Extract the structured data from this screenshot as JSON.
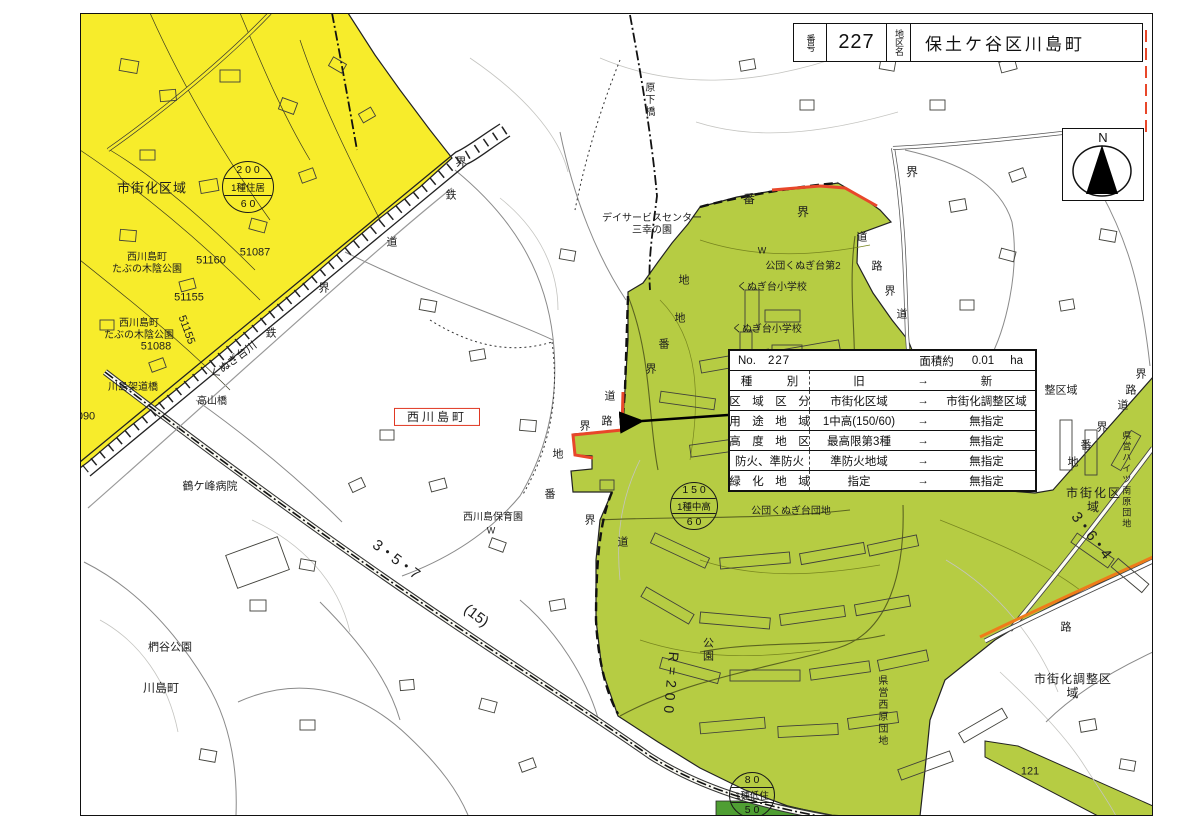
{
  "header": {
    "no_label": "番号",
    "no_value": "227",
    "name_label": "地区名",
    "name_value": "保土ケ谷区川島町"
  },
  "compass": {
    "north_label": "N"
  },
  "info_table": {
    "no_label": "No.",
    "no_value": "227",
    "area_label": "面積約",
    "area_value": "0.01",
    "area_unit": "ha",
    "arrow": "→",
    "rows": [
      {
        "label": "種　　　別",
        "old": "旧",
        "new": "新"
      },
      {
        "label": "区　域　区　分",
        "old": "市街化区域",
        "new": "市街化調整区域"
      },
      {
        "label": "用　途　地　域",
        "old": "1中高(150/60)",
        "new": "無指定"
      },
      {
        "label": "高　度　地　区",
        "old": "最高限第3種",
        "new": "無指定"
      },
      {
        "label": "防火、準防火",
        "old": "準防火地域",
        "new": "無指定"
      },
      {
        "label": "緑　化　地　域",
        "old": "指定",
        "new": "無指定"
      }
    ]
  },
  "colors": {
    "urbanization_yellow": "#f7ec2b",
    "estate_green": "#b6cc43",
    "dark_green": "#4f9e33",
    "boundary_red": "#e8472a",
    "road_orange": "#ef7b1a"
  },
  "zoning_circles": [
    {
      "x": 248,
      "y": 187,
      "r": 26,
      "lines": [
        "2 0 0",
        "1種住居",
        "6 0"
      ]
    },
    {
      "x": 694,
      "y": 506,
      "r": 24,
      "lines": [
        "1 5 0",
        "1種中高",
        "6 0"
      ]
    },
    {
      "x": 752,
      "y": 795,
      "r": 23,
      "lines": [
        "8 0",
        "1種低住",
        "5 0"
      ]
    }
  ],
  "map_labels": [
    {
      "t": "市街化区域",
      "x": 152,
      "y": 188,
      "s": 13,
      "sp": 1
    },
    {
      "t": "西川島町\nたぶの木陰公園",
      "x": 147,
      "y": 264,
      "s": 10
    },
    {
      "t": "51160",
      "x": 211,
      "y": 261,
      "s": 11
    },
    {
      "t": "51087",
      "x": 255,
      "y": 253,
      "s": 11
    },
    {
      "t": "51155",
      "x": 189,
      "y": 298,
      "s": 11
    },
    {
      "t": "51155",
      "x": 186,
      "y": 330,
      "s": 11,
      "r": 70
    },
    {
      "t": "西川島町\nたぶの木陰公園",
      "x": 139,
      "y": 330,
      "s": 10
    },
    {
      "t": "51088",
      "x": 156,
      "y": 347,
      "s": 11
    },
    {
      "t": "090",
      "x": 86,
      "y": 417,
      "s": 11
    },
    {
      "t": "川島架道橋",
      "x": 133,
      "y": 388,
      "s": 10
    },
    {
      "t": "高山橋",
      "x": 212,
      "y": 402,
      "s": 10
    },
    {
      "t": "くぬぎ台川",
      "x": 234,
      "y": 361,
      "s": 11,
      "r": -37
    },
    {
      "t": "界",
      "x": 461,
      "y": 163,
      "s": 11
    },
    {
      "t": "鉄",
      "x": 451,
      "y": 196,
      "s": 11
    },
    {
      "t": "道",
      "x": 392,
      "y": 243,
      "s": 11
    },
    {
      "t": "界",
      "x": 324,
      "y": 289,
      "s": 11
    },
    {
      "t": "鉄",
      "x": 271,
      "y": 334,
      "s": 11
    },
    {
      "t": "鶴ケ峰病院",
      "x": 210,
      "y": 487,
      "s": 11
    },
    {
      "t": "椚谷公園",
      "x": 170,
      "y": 648,
      "s": 11
    },
    {
      "t": "川島町",
      "x": 161,
      "y": 688,
      "s": 12
    },
    {
      "t": "3・5・7",
      "x": 396,
      "y": 560,
      "s": 15,
      "r": 37
    },
    {
      "t": "(15)",
      "x": 476,
      "y": 616,
      "s": 15,
      "r": 37
    },
    {
      "t": "西川島町",
      "x": 437,
      "y": 417,
      "s": 12,
      "box": true
    },
    {
      "t": "西川島保育園",
      "x": 493,
      "y": 518,
      "s": 10
    },
    {
      "t": "W",
      "x": 491,
      "y": 531,
      "s": 9
    },
    {
      "t": "デイサービスセンター\n三幸の園",
      "x": 652,
      "y": 225,
      "s": 10
    },
    {
      "t": "原下橋",
      "x": 648,
      "y": 100,
      "s": 10,
      "v": true
    },
    {
      "t": "地",
      "x": 684,
      "y": 281,
      "s": 11
    },
    {
      "t": "地",
      "x": 680,
      "y": 319,
      "s": 11
    },
    {
      "t": "番",
      "x": 664,
      "y": 345,
      "s": 11
    },
    {
      "t": "界",
      "x": 651,
      "y": 370,
      "s": 11
    },
    {
      "t": "道",
      "x": 610,
      "y": 397,
      "s": 11
    },
    {
      "t": "路",
      "x": 607,
      "y": 422,
      "s": 11
    },
    {
      "t": "界",
      "x": 585,
      "y": 427,
      "s": 11
    },
    {
      "t": "地",
      "x": 558,
      "y": 455,
      "s": 11
    },
    {
      "t": "番",
      "x": 550,
      "y": 495,
      "s": 11
    },
    {
      "t": "界",
      "x": 590,
      "y": 521,
      "s": 11
    },
    {
      "t": "道",
      "x": 623,
      "y": 543,
      "s": 11
    },
    {
      "t": "番",
      "x": 749,
      "y": 199,
      "s": 12
    },
    {
      "t": "界",
      "x": 803,
      "y": 212,
      "s": 12
    },
    {
      "t": "界",
      "x": 912,
      "y": 172,
      "s": 12
    },
    {
      "t": "道",
      "x": 862,
      "y": 238,
      "s": 11
    },
    {
      "t": "路",
      "x": 877,
      "y": 267,
      "s": 11
    },
    {
      "t": "界",
      "x": 890,
      "y": 292,
      "s": 11
    },
    {
      "t": "道",
      "x": 902,
      "y": 315,
      "s": 11
    },
    {
      "t": "W",
      "x": 762,
      "y": 251,
      "s": 9
    },
    {
      "t": "公団くぬぎ台第2",
      "x": 803,
      "y": 267,
      "s": 10
    },
    {
      "t": "くぬぎ台小学校",
      "x": 772,
      "y": 288,
      "s": 10
    },
    {
      "t": "くぬぎ台小学校",
      "x": 767,
      "y": 330,
      "s": 10
    },
    {
      "t": "公団くぬぎ台団地",
      "x": 791,
      "y": 512,
      "s": 10
    },
    {
      "t": "公園",
      "x": 707,
      "y": 650,
      "s": 11,
      "v": true
    },
    {
      "t": "R=200",
      "x": 671,
      "y": 685,
      "s": 14,
      "r": 95,
      "sp": 5
    },
    {
      "t": "県営西原団地",
      "x": 881,
      "y": 711,
      "s": 10,
      "v": true
    },
    {
      "t": "整区域",
      "x": 1061,
      "y": 391,
      "s": 11
    },
    {
      "t": "界",
      "x": 1141,
      "y": 375,
      "s": 11
    },
    {
      "t": "路",
      "x": 1131,
      "y": 391,
      "s": 11
    },
    {
      "t": "道",
      "x": 1123,
      "y": 406,
      "s": 11
    },
    {
      "t": "界",
      "x": 1102,
      "y": 428,
      "s": 11
    },
    {
      "t": "番",
      "x": 1086,
      "y": 446,
      "s": 11
    },
    {
      "t": "地",
      "x": 1073,
      "y": 463,
      "s": 11
    },
    {
      "t": "市街化区域",
      "x": 1094,
      "y": 500,
      "s": 12,
      "sp": 2
    },
    {
      "t": "県営ハイツ南原団地",
      "x": 1126,
      "y": 480,
      "s": 9,
      "v": true
    },
    {
      "t": "3・6・4",
      "x": 1091,
      "y": 536,
      "s": 15,
      "r": 52
    },
    {
      "t": "路",
      "x": 1066,
      "y": 628,
      "s": 11
    },
    {
      "t": "市街化調整区域",
      "x": 1073,
      "y": 686,
      "s": 12,
      "sp": 1
    },
    {
      "t": "121",
      "x": 1030,
      "y": 772,
      "s": 11
    }
  ]
}
